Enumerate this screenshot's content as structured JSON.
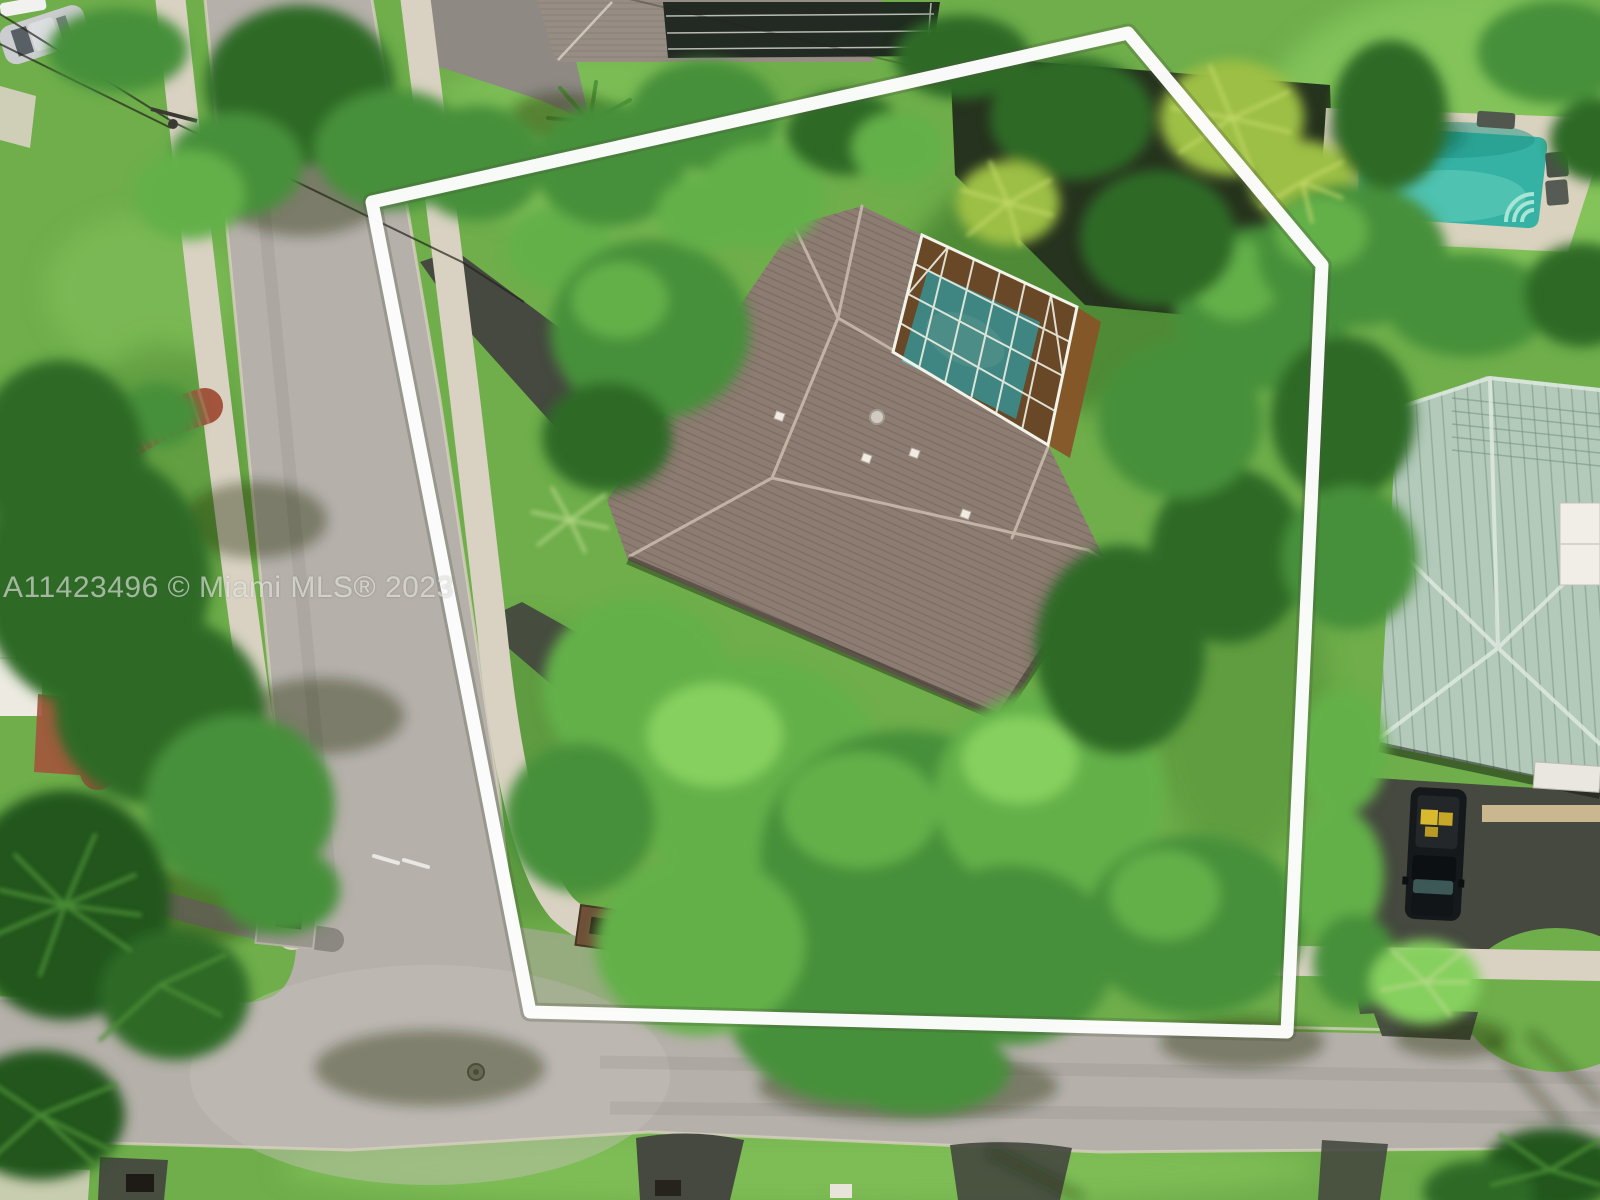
{
  "watermark": {
    "text": "A11423496 © Miami MLS® 2023"
  },
  "boundary": {
    "points": "372,202 1128,33 1322,265 1287,1032 530,1012",
    "color": "#ffffff"
  },
  "scene": {
    "description": "Aerial drone photo of a corner-lot single-family home with a brown hip roof and a screened turquoise pool; the lot is outlined in white",
    "setting": "suburban residential neighborhood, two streets meeting at a corner",
    "objects": {
      "subject_house": "brown shingle hip roof with roof vents",
      "pool_enclosure": "white-framed screen enclosure over turquoise pool and bronze deck",
      "neighbor_pool_top_right": "open turquoise pool with pale deck and lounge chairs",
      "neighbor_house_right": "seafoam green metal hip roof with white chimney",
      "vehicle_right_driveway": "black pickup truck with yellow cargo in bed",
      "parked_car_top_left": "silver car",
      "west_yard": "red brick garden path, white flat-roof structure, palms",
      "streets": "light gray asphalt with concrete sidewalks and dark driveway aprons"
    }
  },
  "palette": {
    "grass-base": "#6fae4b",
    "grass-light": "#8ac95f",
    "grass-dark": "#4a8531",
    "shadow-green": "rgba(22,38,15,0.38)",
    "asphalt": "#b6b0aa",
    "asphalt-light": "#c6c0ba",
    "concrete": "#d9d2c2",
    "concrete-shade": "#8b8781",
    "drive-dark": "#45493f",
    "roof-brown": "#8d7c72",
    "roof-ridge": "#c7b9ab",
    "tile-gray": "#978d84",
    "lanai-dark": "#1c241e",
    "metal-green": "#b3c9ba",
    "metal-ridge": "#dde9de",
    "metal-seam": "#7e9a86",
    "chimney-white": "#f0eee6",
    "pool-teal": "#36b2a4",
    "pool-cyan": "#5cc9c9",
    "deck-bronze": "#a06434",
    "deck-pale": "#d9d2be",
    "brick-red": "#a3543c",
    "building-white": "#eceae1",
    "accent-teal": "#3f9fae",
    "truck-black": "#16191c",
    "cargo-yellow": "#d9b92e",
    "car-silver": "#cbcdcf",
    "tree-dark": "#2e6b28",
    "tree-mid": "#47903a",
    "tree-bright": "#63b048",
    "tree-light": "#86d05f",
    "tree-yellow": "#9dbf45",
    "palm-dark": "#20561f",
    "frond": "#4e9036",
    "pole-dark": "#3b3a34",
    "wire": "rgba(35,34,28,0.7)",
    "boundary-white": "#ffffff",
    "watermark": "rgba(255,255,255,0.55)"
  }
}
